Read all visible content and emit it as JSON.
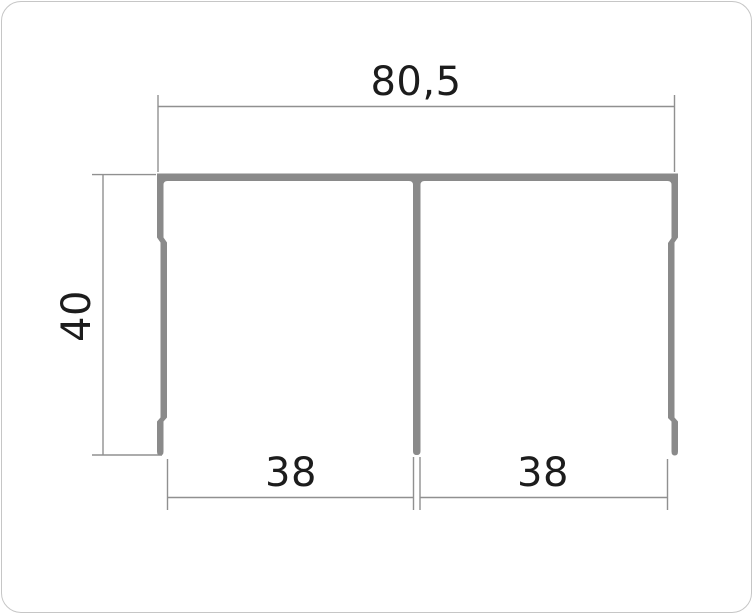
{
  "diagram": {
    "title": "aluminium-profile-cross-section",
    "card_border_color": "#c6c6c6",
    "profile_color": "#8a8a8a",
    "dimension_line_color": "#909090",
    "text_color": "#1c1c1c",
    "dimensions": {
      "overall_width": {
        "label": "80,5"
      },
      "overall_height": {
        "label": "40"
      },
      "left_channel_width": {
        "label": "38"
      },
      "right_channel_width": {
        "label": "38"
      }
    }
  }
}
